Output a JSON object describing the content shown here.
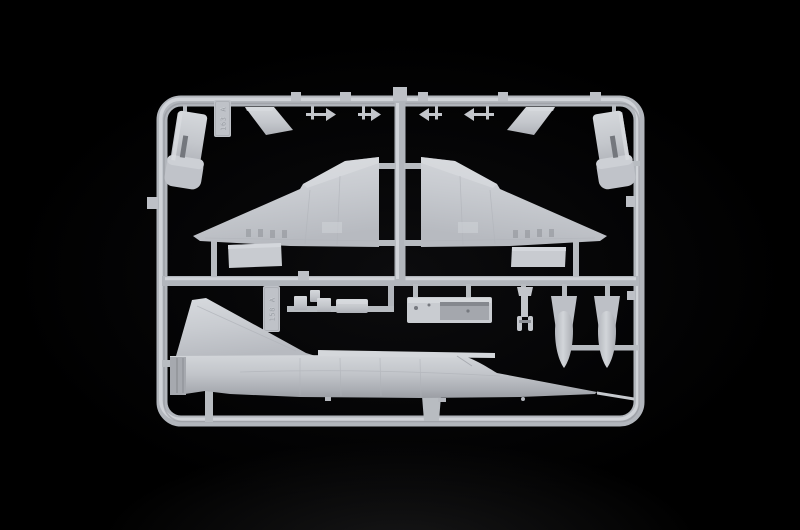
{
  "scene": {
    "type": "photograph",
    "subject": "Light grey injection-moulded model kit sprue (parts frame) of a delta-wing jet aircraft on a black background",
    "background_color": "#000000",
    "plastic_color": "#c6c9ce",
    "plastic_highlight": "#d8dbdf",
    "plastic_shadow": "#9a9da3"
  },
  "sprue": {
    "tag_top": {
      "text": "163 A"
    },
    "tag_bottom": {
      "text": "158 A"
    },
    "parts": [
      "exhaust-duct-half-left",
      "sprue-code-tag-top",
      "intake-ramp-left",
      "antenna-arrow-parts",
      "intake-ramp-right",
      "exhaust-duct-half-right",
      "delta-wing-left",
      "delta-wing-right",
      "elevon-flap-left",
      "elevon-flap-right",
      "sprue-code-tag-bottom",
      "small-fairing-parts",
      "cockpit-tub-box",
      "nose-landing-gear-leg",
      "drop-tank-halves",
      "fuselage-half-with-tail-fin",
      "pitot-probe"
    ]
  }
}
